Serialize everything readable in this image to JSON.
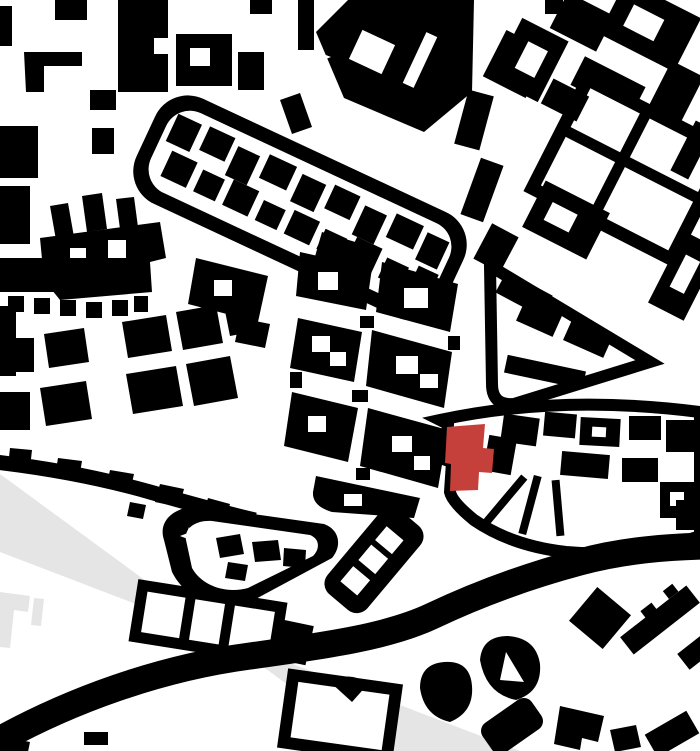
{
  "map": {
    "kind": "figure-ground-urban-plan",
    "highlight": {
      "name": "site-building",
      "color": "#c5403a"
    },
    "marker_glyph": "four-point-star",
    "marker_count": 2
  },
  "colors": {
    "background": "#ffffff",
    "buildings": "#000000",
    "streets": "#ffffff",
    "highlight": "#c5403a",
    "watermark": "#e5e5e5"
  }
}
